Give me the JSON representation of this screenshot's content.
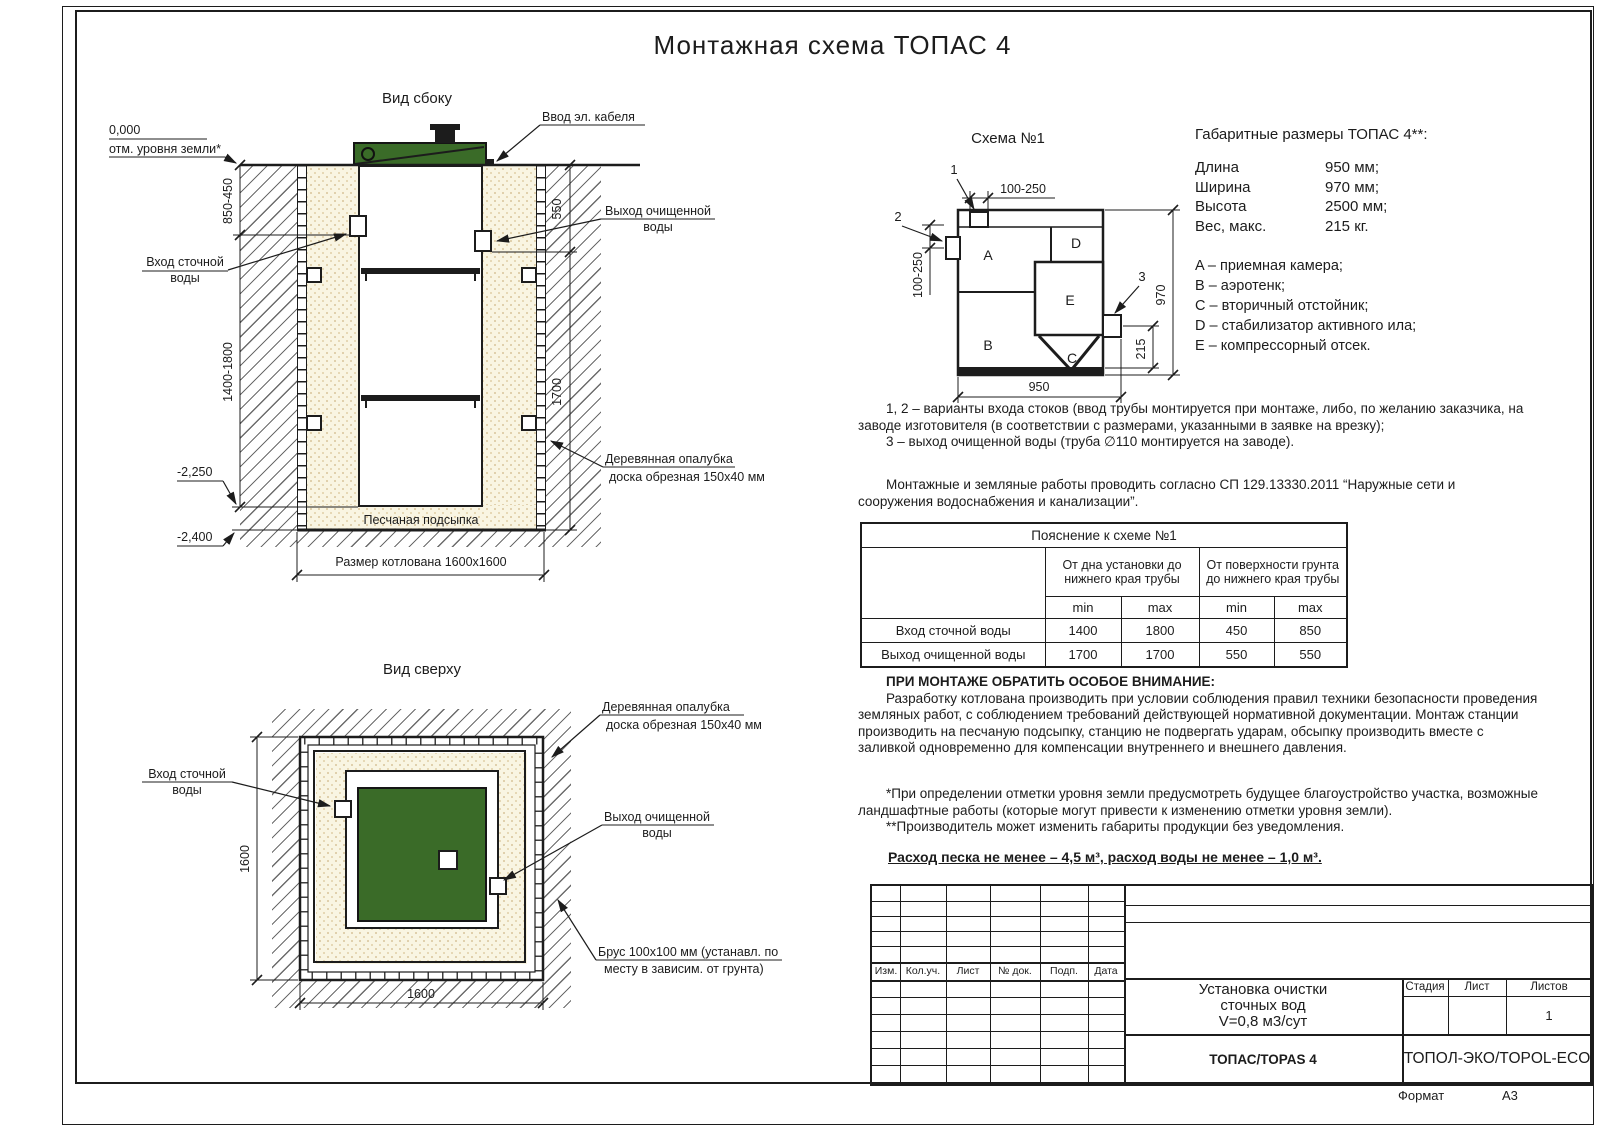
{
  "page": {
    "title": "Монтажная схема ТОПАС 4",
    "format_label": "Формат",
    "format_value": "А3"
  },
  "side_view": {
    "title": "Вид сбоку",
    "zero_mark": "0,000",
    "ground_note": "отм. уровня земли*",
    "cable_label": "Ввод эл. кабеля",
    "inlet_line1": "Вход сточной",
    "inlet_line2": "воды",
    "outlet_line1": "Выход очищенной",
    "outlet_line2": "воды",
    "formwork_line1": "Деревянная опалубка",
    "formwork_line2": "доска обрезная 150x40 мм",
    "dim_850": "850-450",
    "dim_1400": "1400-1800",
    "dim_550": "550",
    "dim_1700": "1700",
    "level_2250": "-2,250",
    "level_2400": "-2,400",
    "sand_label": "Песчаная подсыпка",
    "pit_label": "Размер котлована 1600x1600"
  },
  "top_view": {
    "title": "Вид сверху",
    "inlet_line1": "Вход сточной",
    "inlet_line2": "воды",
    "outlet_line1": "Выход очищенной",
    "outlet_line2": "воды",
    "formwork_line1": "Деревянная опалубка",
    "formwork_line2": "доска обрезная 150x40 мм",
    "beam_line1": "Брус 100x100 мм (устанавл. по",
    "beam_line2": "месту в зависим. от грунта)",
    "dim_width": "1600",
    "dim_height": "1600"
  },
  "schema": {
    "title": "Схема №1",
    "comp_a": "A",
    "comp_b": "B",
    "comp_c": "C",
    "comp_d": "D",
    "comp_e": "E",
    "marker_1": "1",
    "marker_2": "2",
    "marker_3": "3",
    "dim_top": "100-250",
    "dim_left": "100-250",
    "dim_right": "970",
    "dim_outlet": "215",
    "dim_bottom": "950"
  },
  "specs": {
    "heading": "Габаритные размеры ТОПАС 4**:",
    "rows": [
      {
        "label": "Длина",
        "value": "950 мм;"
      },
      {
        "label": "Ширина",
        "value": "970 мм;"
      },
      {
        "label": "Высота",
        "value": "2500 мм;"
      },
      {
        "label": "Вес, макс.",
        "value": "215 кг."
      }
    ],
    "legend": [
      "A – приемная камера;",
      "B – аэротенк;",
      "C – вторичный отстойник;",
      "D – стабилизатор активного ила;",
      "E – компрессорный отсек."
    ]
  },
  "notes": {
    "variants_1": "1, 2 – варианты входа  стоков (ввод трубы монтируется при монтаже, либо, по желанию заказчика, на заводе изготовителя (в соответствии с размерами, указанными в заявке на врезку);",
    "variants_2": "3 – выход очищенной воды (труба ∅110 монтируется на заводе).",
    "sp": "Монтажные и земляные работы проводить согласно СП 129.13330.2011 “Наружные сети и сооружения водоснабжения и канализации”.",
    "attention_title": "ПРИ МОНТАЖЕ ОБРАТИТЬ ОСОБОЕ ВНИМАНИЕ:",
    "attention_body": "Разработку котлована производить при условии соблюдения правил техники безопасности проведения земляных работ, с соблюдением требований действующей нормативной документации. Монтаж станции производить на песчаную подсыпку, станцию не подвергать ударам, обсыпку производить вместе с заливкой одновременно для компенсации внутреннего и внешнего давления.",
    "footnote_1": "*При определении отметки уровня земли предусмотреть будущее благоустройство участка, возможные ландшафтные работы (которые могут привести к изменению отметки уровня земли).",
    "footnote_2": "**Производитель может изменить габариты продукции без уведомления.",
    "consumption": "Расход песка не менее – 4,5 м³, расход воды не менее – 1,0 м³."
  },
  "table": {
    "title": "Пояснение к схеме №1",
    "group1": "От дна установки до нижнего края трубы",
    "group2": "От поверхности грунта до нижнего края трубы",
    "min": "min",
    "max": "max",
    "rows": [
      {
        "label": "Вход сточной воды",
        "c1": "1400",
        "c2": "1800",
        "c3": "450",
        "c4": "850"
      },
      {
        "label": "Выход очищенной воды",
        "c1": "1700",
        "c2": "1700",
        "c3": "550",
        "c4": "550"
      }
    ]
  },
  "title_block": {
    "rev_cols": [
      "Изм.",
      "Кол.уч.",
      "Лист",
      "№ док.",
      "Подп.",
      "Дата"
    ],
    "doc_line1": "Установка очистки",
    "doc_line2": "сточных вод",
    "doc_line3": "V=0,8 м3/сут",
    "stage": "Стадия",
    "sheet": "Лист",
    "sheets": "Листов",
    "sheets_value": "1",
    "model": "ТОПАС/TOPAS 4",
    "company": "ТОПОЛ-ЭКО/TOPOL-ECO"
  },
  "colors": {
    "lid_green": "#3a6b28",
    "line": "#1c1c1c",
    "sand_base": "#f9f5e2",
    "sand_dot": "#d8c49a"
  }
}
